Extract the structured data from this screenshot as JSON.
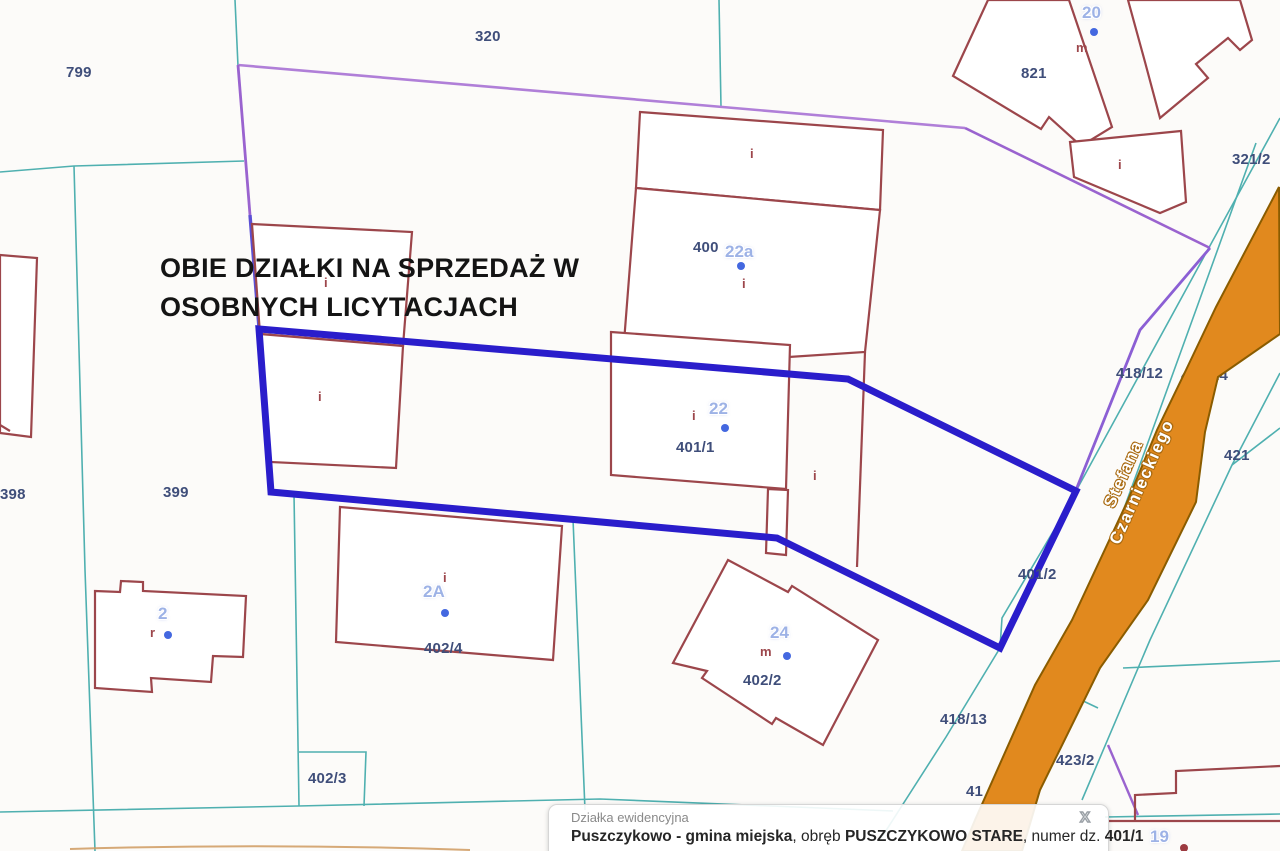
{
  "annotation": {
    "line1": "OBIE DZIAŁKI NA SPRZEDAŻ W",
    "line2": "OSOBNYCH LICYTACJACH"
  },
  "road": {
    "name": "Stefana Czarnieckiego"
  },
  "parcel_labels": [
    {
      "id": "320",
      "label": "320"
    },
    {
      "id": "799",
      "label": "799"
    },
    {
      "id": "398",
      "label": "398"
    },
    {
      "id": "399",
      "label": "399"
    },
    {
      "id": "400",
      "label": "400"
    },
    {
      "id": "401/1",
      "label": "401/1"
    },
    {
      "id": "401/2",
      "label": "401/2"
    },
    {
      "id": "402/2",
      "label": "402/2"
    },
    {
      "id": "402/3",
      "label": "402/3"
    },
    {
      "id": "402/4",
      "label": "402/4"
    },
    {
      "id": "418/12",
      "label": "418/12"
    },
    {
      "id": "418/24",
      "label": "418/24"
    },
    {
      "id": "418/13",
      "label": "418/13"
    },
    {
      "id": "423/2",
      "label": "423/2"
    },
    {
      "id": "421",
      "label": "421"
    },
    {
      "id": "321/2",
      "label": "321/2"
    },
    {
      "id": "821",
      "label": "821"
    },
    {
      "id": "41",
      "label": "41"
    }
  ],
  "house_labels": [
    {
      "number": "20",
      "type": "m"
    },
    {
      "number": "22a",
      "type": "i"
    },
    {
      "number": "22",
      "type": "i"
    },
    {
      "number": "2A",
      "type": "i"
    },
    {
      "number": "24",
      "type": "m"
    },
    {
      "number": "2",
      "type": "r"
    },
    {
      "number": "19",
      "type": ""
    }
  ],
  "use_marks": [
    {
      "label": "i"
    },
    {
      "label": "i"
    },
    {
      "label": "i"
    },
    {
      "label": "i"
    },
    {
      "label": "i"
    }
  ],
  "popup": {
    "title": "Działka ewidencyjna",
    "municipality": "Puszczykowo - gmina miejska",
    "obreb_label": ", obręb ",
    "obreb_value": "PUSZCZYKOWO STARE",
    "numer_label": ", numer dz. ",
    "numer_value": "401/1",
    "close_label": "X"
  },
  "theme": {
    "parcel_line": "#4fb0b0",
    "building_line": "#9c464b",
    "highlight_outline": "#2a1dcb",
    "boundary_violet": "#a06fd2",
    "road_fill": "#e1891e",
    "road_edge": "#8a5c00",
    "parcel_label_color": "#3f4e7a",
    "house_number_color": "#9db2e6",
    "marker_dot_color": "#4468e0"
  }
}
